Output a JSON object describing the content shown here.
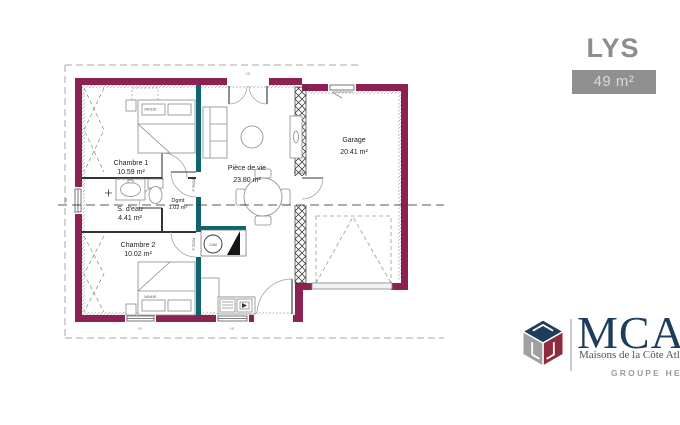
{
  "header": {
    "title": "LYS",
    "area_badge": "49 m²"
  },
  "plan": {
    "rooms": {
      "chambre1": {
        "name": "Chambre 1",
        "area": "10.59 m²"
      },
      "sdeau": {
        "name": "S. d'eau",
        "area": "4.41 m²"
      },
      "chambre2": {
        "name": "Chambre 2",
        "area": "10.02 m²"
      },
      "dgmt": {
        "name": "Dgmt",
        "area": "1.02 m²"
      },
      "piece_de_vie": {
        "name": "Pièce de vie",
        "area": "23.80 m²"
      },
      "garage": {
        "name": "Garage",
        "area": "20.41 m²"
      }
    },
    "annotations": {
      "cum": "CUM",
      "door_tag": "P 75/204",
      "bed_size": "140x190",
      "window_tag": "VR",
      "dim_left": "90"
    }
  },
  "logo": {
    "brand": "MCA",
    "tagline": "Maisons de la Côte Atlantique",
    "group": "GROUPE HEXA"
  },
  "colors": {
    "wall": "#8c2154",
    "iwall": "#0e656d",
    "badge_bg": "#909090",
    "logo_navy": "#1e3c5c",
    "logo_red": "#8f2b3f",
    "logo_gray": "#a0a0a3"
  }
}
